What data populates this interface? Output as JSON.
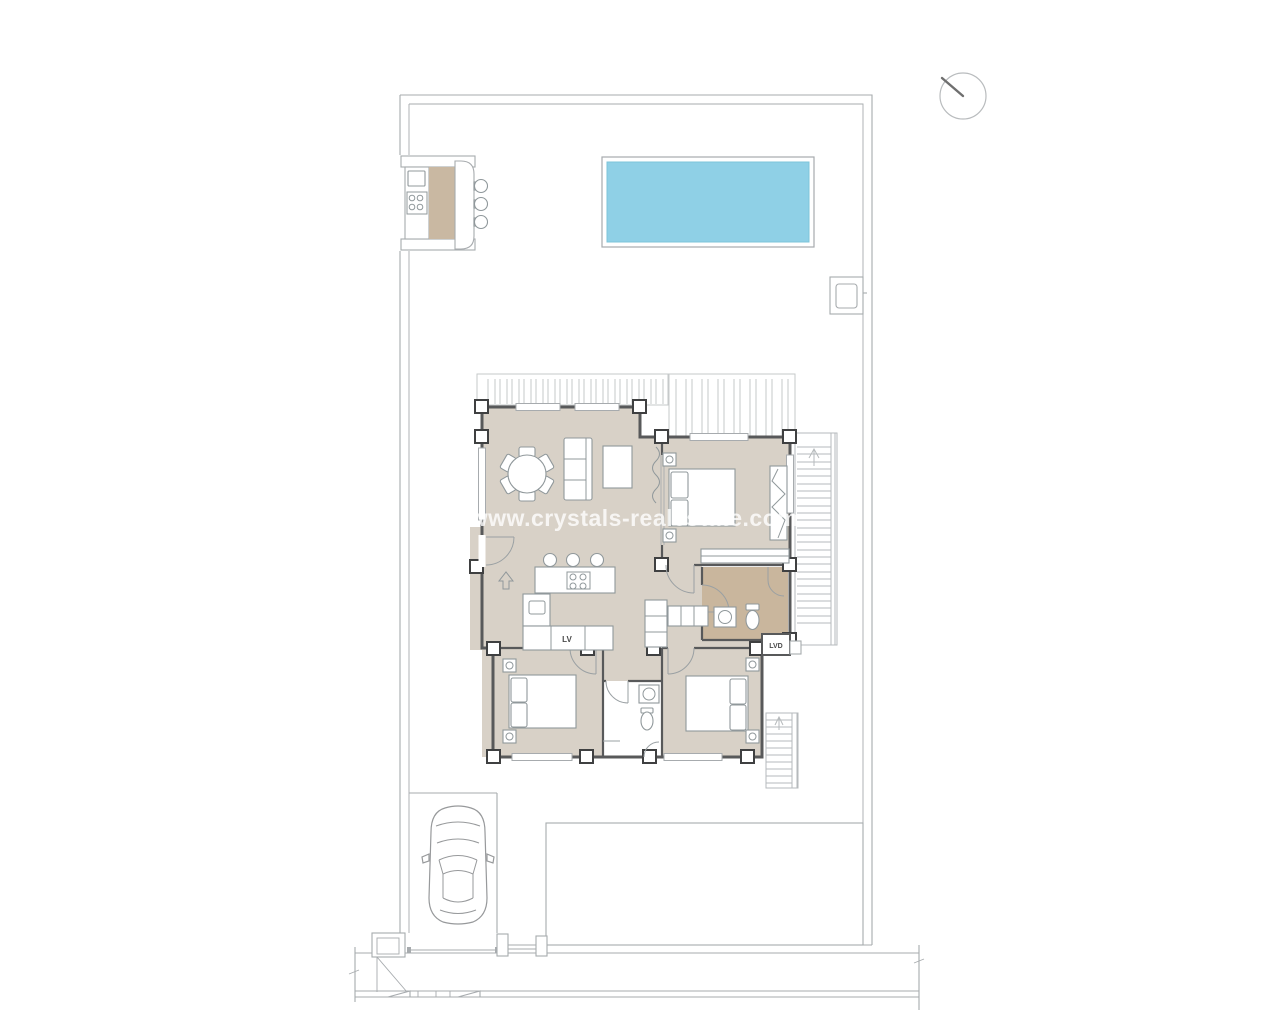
{
  "page": {
    "type": "architectural-floor-plan",
    "view": "villa site plan with pool, ground floor, driveway and street"
  },
  "watermark": {
    "text": "www.crystals-realestate.com"
  },
  "labels": {
    "dishwasher": "LV",
    "washer_dryer": "LVD"
  },
  "icons": {
    "north_indicator": "circle-with-bearing-needle",
    "entry_arrow": "hollow-up-arrow-at-entrance",
    "stairs_up_arrow": "direction-of-travel-arrow"
  },
  "colors": {
    "floor": "#d8d1c7",
    "bathfloor": "#c9b69d",
    "strip": "#c9b8a2",
    "pool": "#8fd0e6",
    "pooledge": "#7cc4da",
    "wall": "#58595a",
    "pillar": "#3f4041",
    "site": "#a7abae",
    "pergola": "#c6c9ca",
    "furn": "#90989b",
    "car": "#97999b",
    "labeltext": "#4a4a4a",
    "watermark": "#ffffff"
  }
}
